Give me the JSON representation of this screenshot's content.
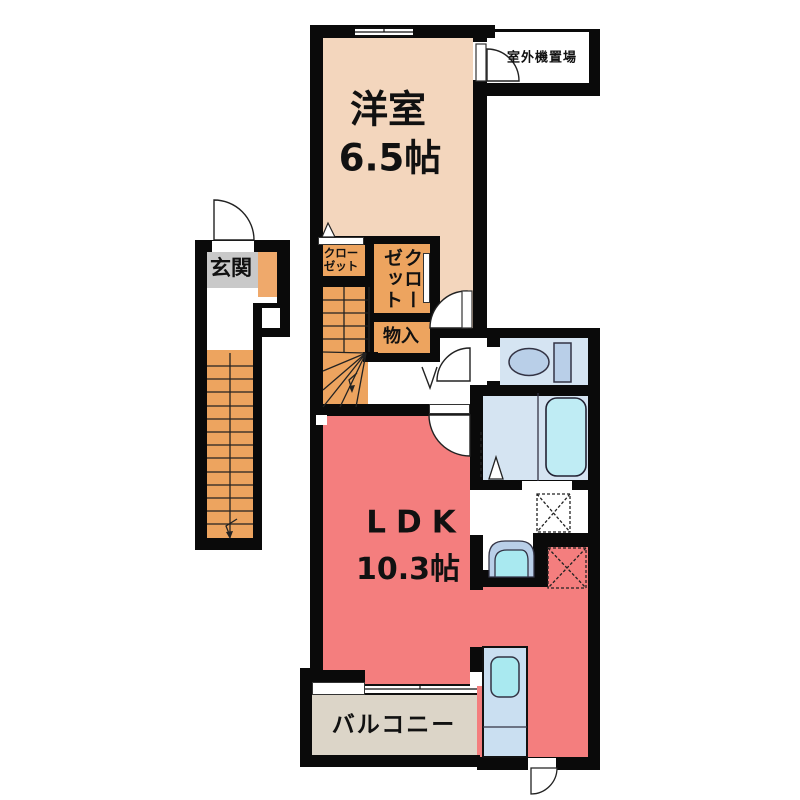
{
  "labels": {
    "western_room_name": "洋室",
    "western_room_size": "6.5帖",
    "outdoor_unit": "室外機置場",
    "entrance": "玄関",
    "closet_upper_line1": "クロー",
    "closet_upper_line2": "ゼット",
    "closet_vertical": "クローゼット",
    "storage": "物入",
    "ldk_name": "LDK",
    "ldk_size": "10.3帖",
    "balcony": "バルコニー"
  },
  "colors": {
    "western_room": "#F3D6BD",
    "closet": "#EDA45F",
    "stairs": "#EDA45F",
    "entrance_floor": "#C9C9C9",
    "shoe_box": "#EFA96B",
    "ldk": "#F47E7E",
    "balcony": "#DCD5C8",
    "sanitary_room": "#D5E4F2",
    "fixture_blue": "#B9CFE8",
    "tub_water": "#BFECF4",
    "kitchen_unit": "#CADFF1",
    "sink_water": "#A9E9F0",
    "wall": "#0A0A0A"
  }
}
